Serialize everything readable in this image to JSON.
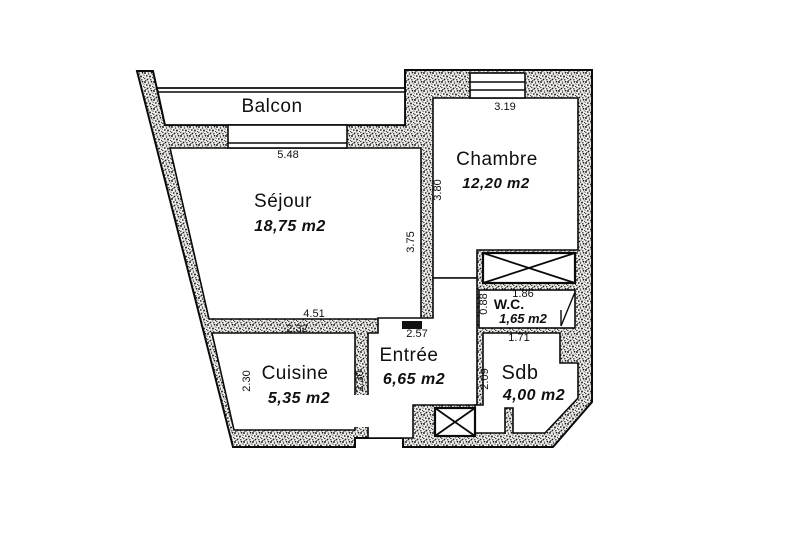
{
  "plan": {
    "type": "apartment-floor-plan",
    "rooms": {
      "balcon": {
        "name": "Balcon",
        "area": ""
      },
      "sejour": {
        "name": "Séjour",
        "area": "18,75 m2"
      },
      "chambre": {
        "name": "Chambre",
        "area": "12,20 m2"
      },
      "cuisine": {
        "name": "Cuisine",
        "area": "5,35 m2"
      },
      "entree": {
        "name": "Entrée",
        "area": "6,65 m2"
      },
      "wc": {
        "name": "W.C.",
        "area": "1,65 m2"
      },
      "sdb": {
        "name": "Sdb",
        "area": "4,00 m2"
      }
    },
    "dimensions": {
      "balcony_window": "5.48",
      "chambre_window": "3.19",
      "chambre_depth": "3.80",
      "sejour_depth": "3.75",
      "entree_top": "4.51",
      "cuisine_width": "2.32",
      "entree_width": "2.57",
      "cuisine_left": "2.30",
      "cuisine_right": "2.30",
      "wc_depth": "0.88",
      "wc_width": "1.86",
      "sdb_width": "1.71",
      "sdb_depth": "2.09"
    },
    "colors": {
      "ink": "#101010",
      "paper": "#ffffff"
    }
  }
}
